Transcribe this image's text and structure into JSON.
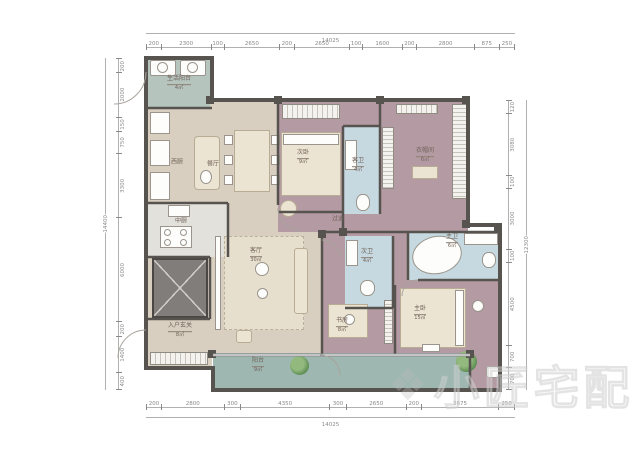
{
  "watermark": {
    "logo": "❖",
    "text": "小匠宅配"
  },
  "dims": {
    "top": {
      "overall": "14025",
      "segments": [
        "200",
        "2300",
        "100",
        "2650",
        "200",
        "2650",
        "100",
        "1600",
        "200",
        "2800",
        "875",
        "250"
      ]
    },
    "bottom": {
      "overall": "14025",
      "segments": [
        "200",
        "2800",
        "300",
        "4350",
        "300",
        "2650",
        "200",
        "3675",
        "250"
      ]
    },
    "left": {
      "overall": "14400",
      "segments": [
        "200",
        "2000",
        "150",
        "750",
        "3300",
        "6000",
        "200",
        "1400",
        "400"
      ]
    },
    "right": {
      "overall": "12300",
      "segments": [
        "120",
        "3080",
        "100",
        "3000",
        "100",
        "4500",
        "700",
        "700"
      ]
    }
  },
  "rooms": [
    {
      "id": "service-balcony",
      "label": "生活阳台",
      "area": "4㎡"
    },
    {
      "id": "west-kitchen",
      "label": "西厨",
      "area": ""
    },
    {
      "id": "dining",
      "label": "餐厅",
      "area": ""
    },
    {
      "id": "mid-kitchen",
      "label": "中厨",
      "area": ""
    },
    {
      "id": "foyer",
      "label": "入户玄关",
      "area": "8㎡"
    },
    {
      "id": "living",
      "label": "客厅",
      "area": "30㎡"
    },
    {
      "id": "corridor",
      "label": "过道",
      "area": ""
    },
    {
      "id": "secondary-bedroom",
      "label": "次卧",
      "area": "9㎡"
    },
    {
      "id": "guest-bath",
      "label": "客卫",
      "area": "4㎡"
    },
    {
      "id": "cloakroom",
      "label": "衣帽间",
      "area": "6㎡"
    },
    {
      "id": "second-bath",
      "label": "次卫",
      "area": "4㎡"
    },
    {
      "id": "master-bath",
      "label": "主卫",
      "area": "6㎡"
    },
    {
      "id": "study",
      "label": "书房",
      "area": "8㎡"
    },
    {
      "id": "master-bedroom",
      "label": "主卧",
      "area": "15㎡"
    },
    {
      "id": "balcony",
      "label": "阳台",
      "area": "9㎡"
    }
  ]
}
